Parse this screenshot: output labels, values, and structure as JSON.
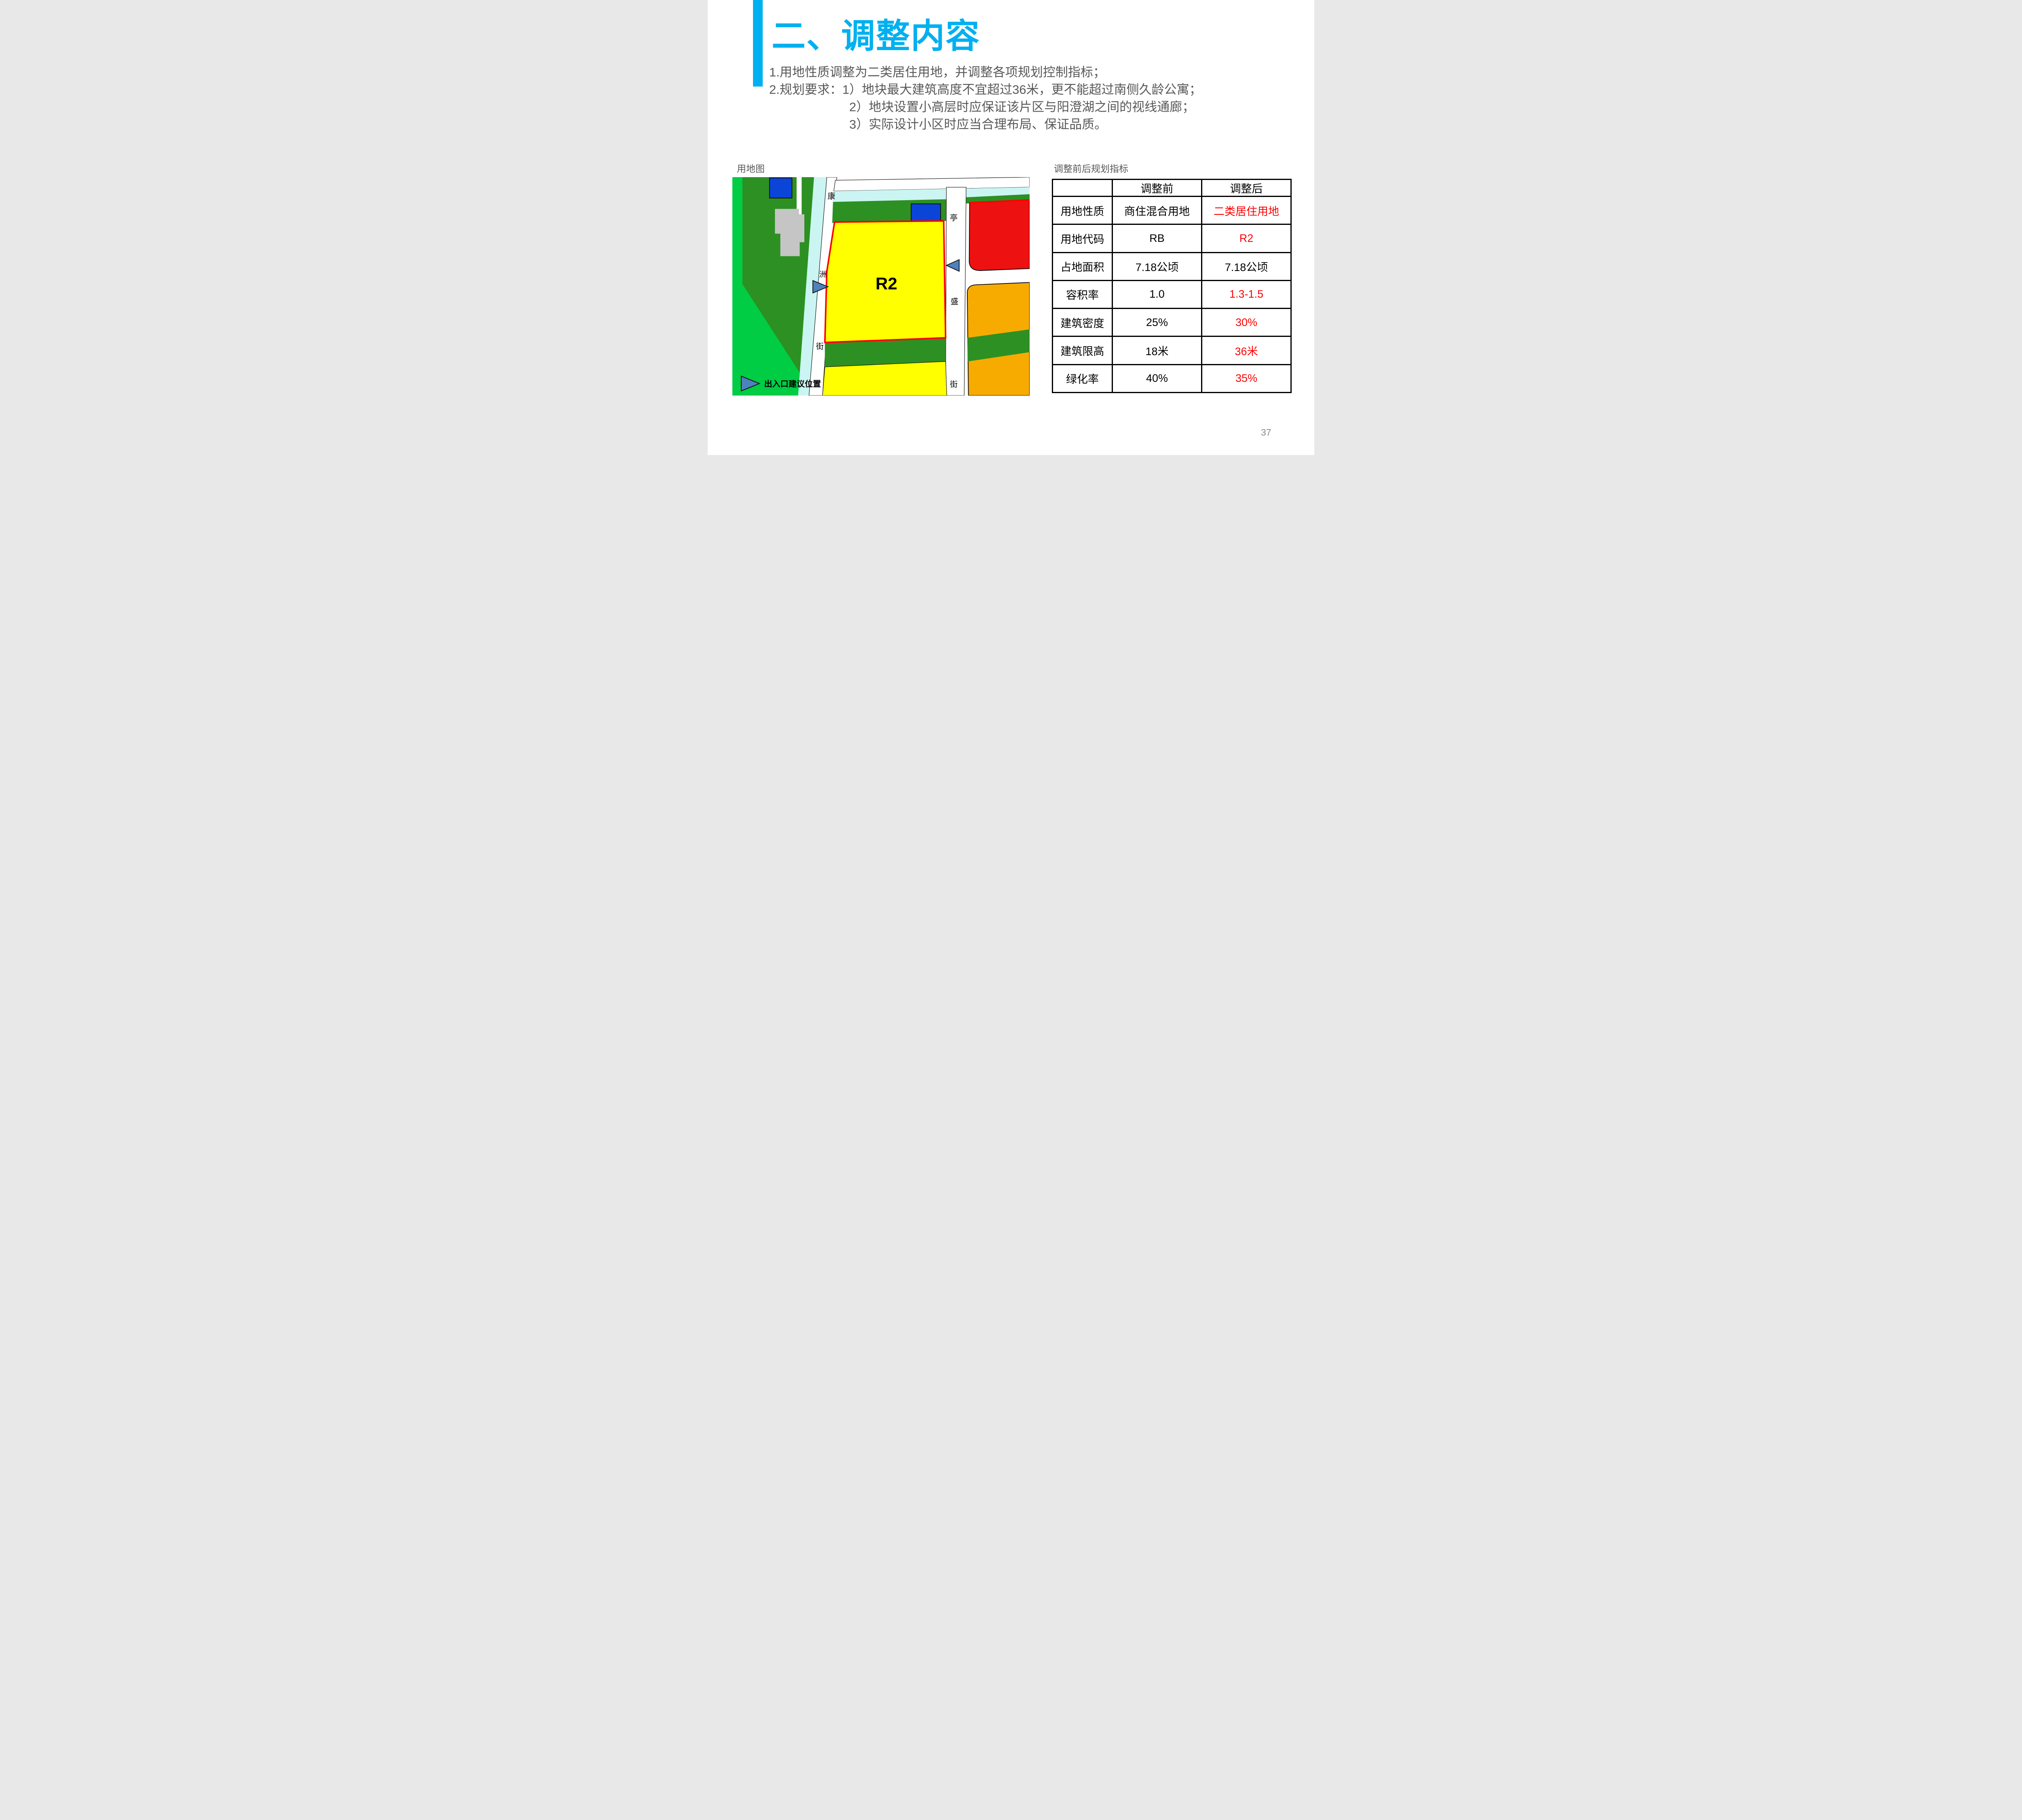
{
  "page": {
    "number": "37"
  },
  "title": {
    "text": "二、调整内容"
  },
  "body_lines": [
    {
      "text": "1.用地性质调整为二类居住用地，并调整各项规划控制指标；"
    },
    {
      "text": "2.规划要求：1）地块最大建筑高度不宜超过36米，更不能超过南侧久龄公寓；"
    },
    {
      "text": "2）地块设置小高层时应保证该片区与阳澄湖之间的视线通廊；"
    },
    {
      "text": "3）实际设计小区时应当合理布局、保证品质。"
    }
  ],
  "map": {
    "label": "用地图",
    "parcel_label": "R2",
    "legend_label": "出入口建议位置",
    "road_left_chars": [
      "康",
      "洲",
      "街"
    ],
    "road_right_chars": [
      "亭",
      "盛",
      "街"
    ]
  },
  "table": {
    "label": "调整前后规划指标",
    "headers": [
      "",
      "调整前",
      "调整后"
    ],
    "rows": [
      {
        "name": "用地性质",
        "before": "商住混合用地",
        "after": "二类居住用地",
        "after_red": true
      },
      {
        "name": "用地代码",
        "before": "RB",
        "after": "R2",
        "after_red": true
      },
      {
        "name": "占地面积",
        "before": "7.18公顷",
        "after": "7.18公顷",
        "after_red": false
      },
      {
        "name": "容积率",
        "before": "1.0",
        "after": "1.3-1.5",
        "after_red": true
      },
      {
        "name": "建筑密度",
        "before": "25%",
        "after": "30%",
        "after_red": true
      },
      {
        "name": "建筑限高",
        "before": "18米",
        "after": "36米",
        "after_red": true
      },
      {
        "name": "绿化率",
        "before": "40%",
        "after": "35%",
        "after_red": true
      }
    ]
  },
  "colors": {
    "title_cyan": "#00B0F0",
    "body_gray": "#595959",
    "pagenum_gray": "#8a8a8a",
    "value_red": "#FF0000",
    "bright_green": "#00CC44",
    "dark_green": "#2D9022",
    "canal_cyan": "#CBF5F2",
    "road_white": "#FFFFFF",
    "parcel_yellow": "#FFFF00",
    "parcel_red": "#EE1111",
    "parcel_orange": "#F7AB00",
    "water_blue": "#0A45D8",
    "building_gray": "#C5C5C5",
    "marker_blue": "#4F81BD",
    "parcel_border_red": "#FF0000",
    "line_black": "#111111"
  }
}
